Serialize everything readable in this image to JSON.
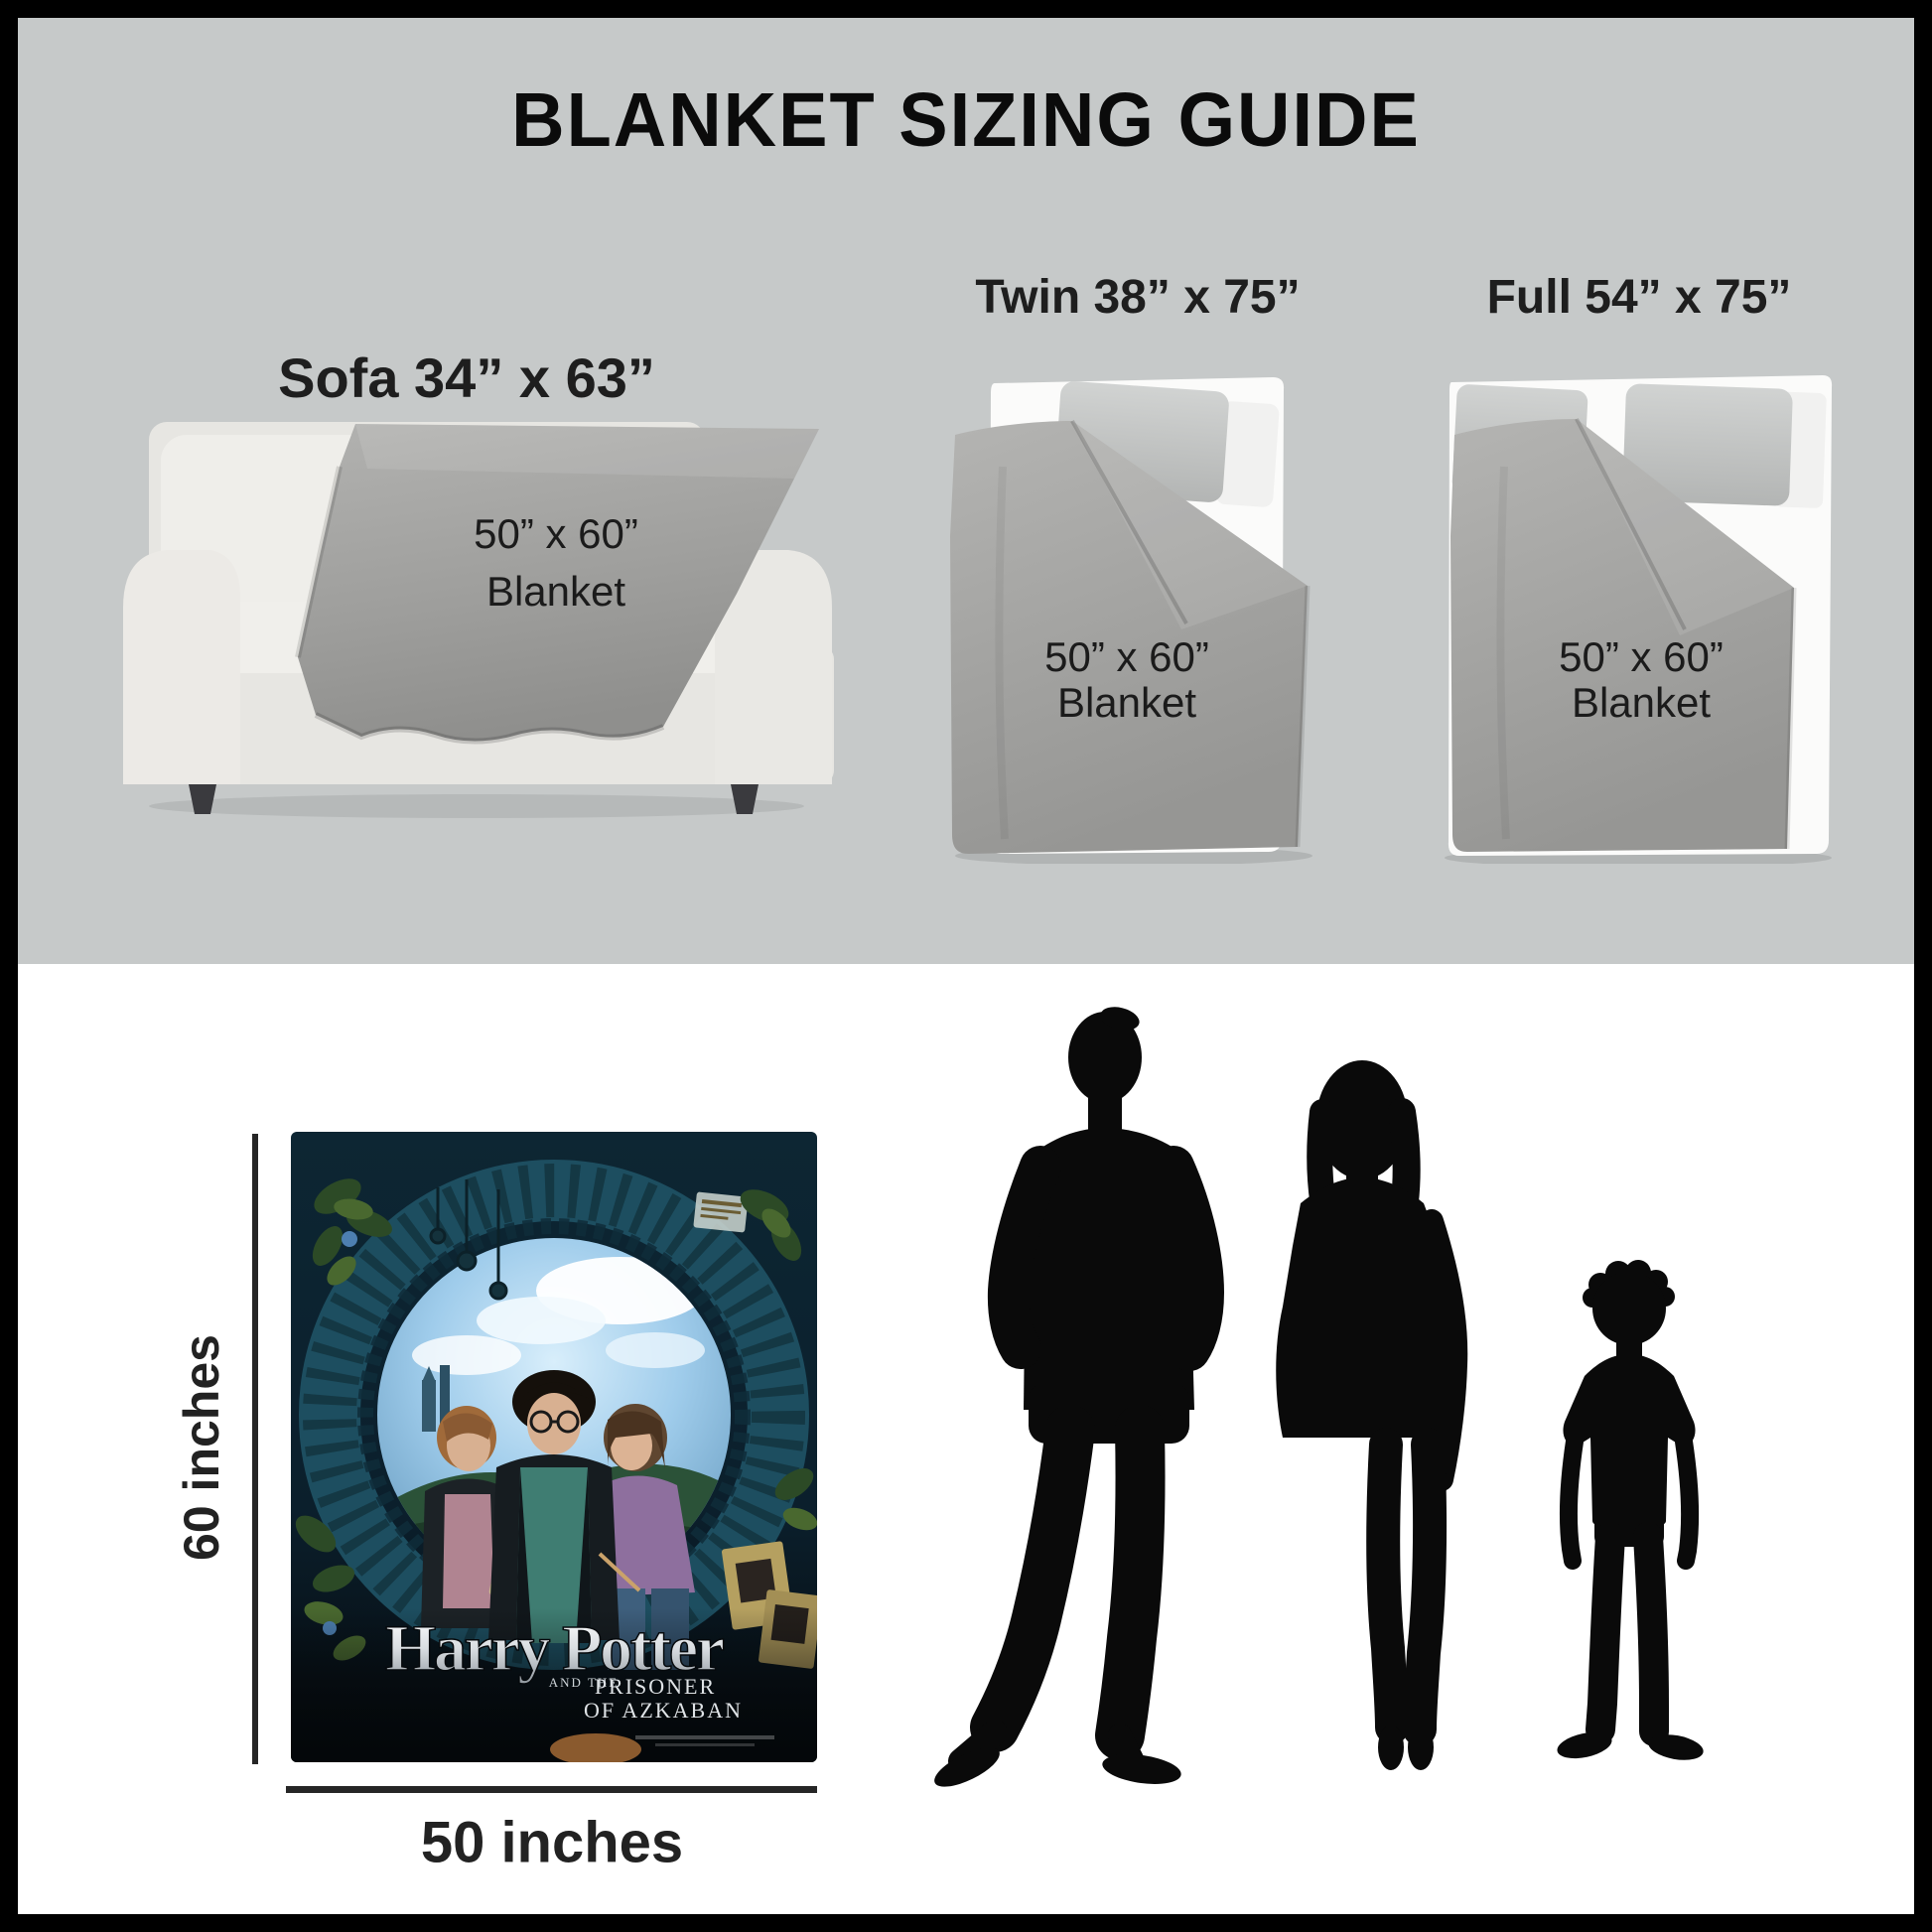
{
  "title": "BLANKET SIZING GUIDE",
  "options": [
    {
      "id": "sofa",
      "label": "Sofa 34” x 63”",
      "blanket_size": "50” x 60”",
      "blanket_word": "Blanket"
    },
    {
      "id": "twin",
      "label": "Twin 38” x 75”",
      "blanket_size": "50” x 60”",
      "blanket_word": "Blanket"
    },
    {
      "id": "full",
      "label": "Full 54” x 75”",
      "blanket_size": "50” x 60”",
      "blanket_word": "Blanket"
    }
  ],
  "dimensions": {
    "height_label": "60 inches",
    "width_label": "50 inches"
  },
  "poster": {
    "title": "Harry Potter",
    "subtitle_small": "AND THE",
    "subtitle_line1": "PRISONER",
    "subtitle_line2": "OF AZKABAN"
  },
  "colors": {
    "panel_gray": "#c6c9c9",
    "blanket_gray": "#a0a09e",
    "line_black": "#262626",
    "silhouette_black": "#0a0a0a"
  }
}
